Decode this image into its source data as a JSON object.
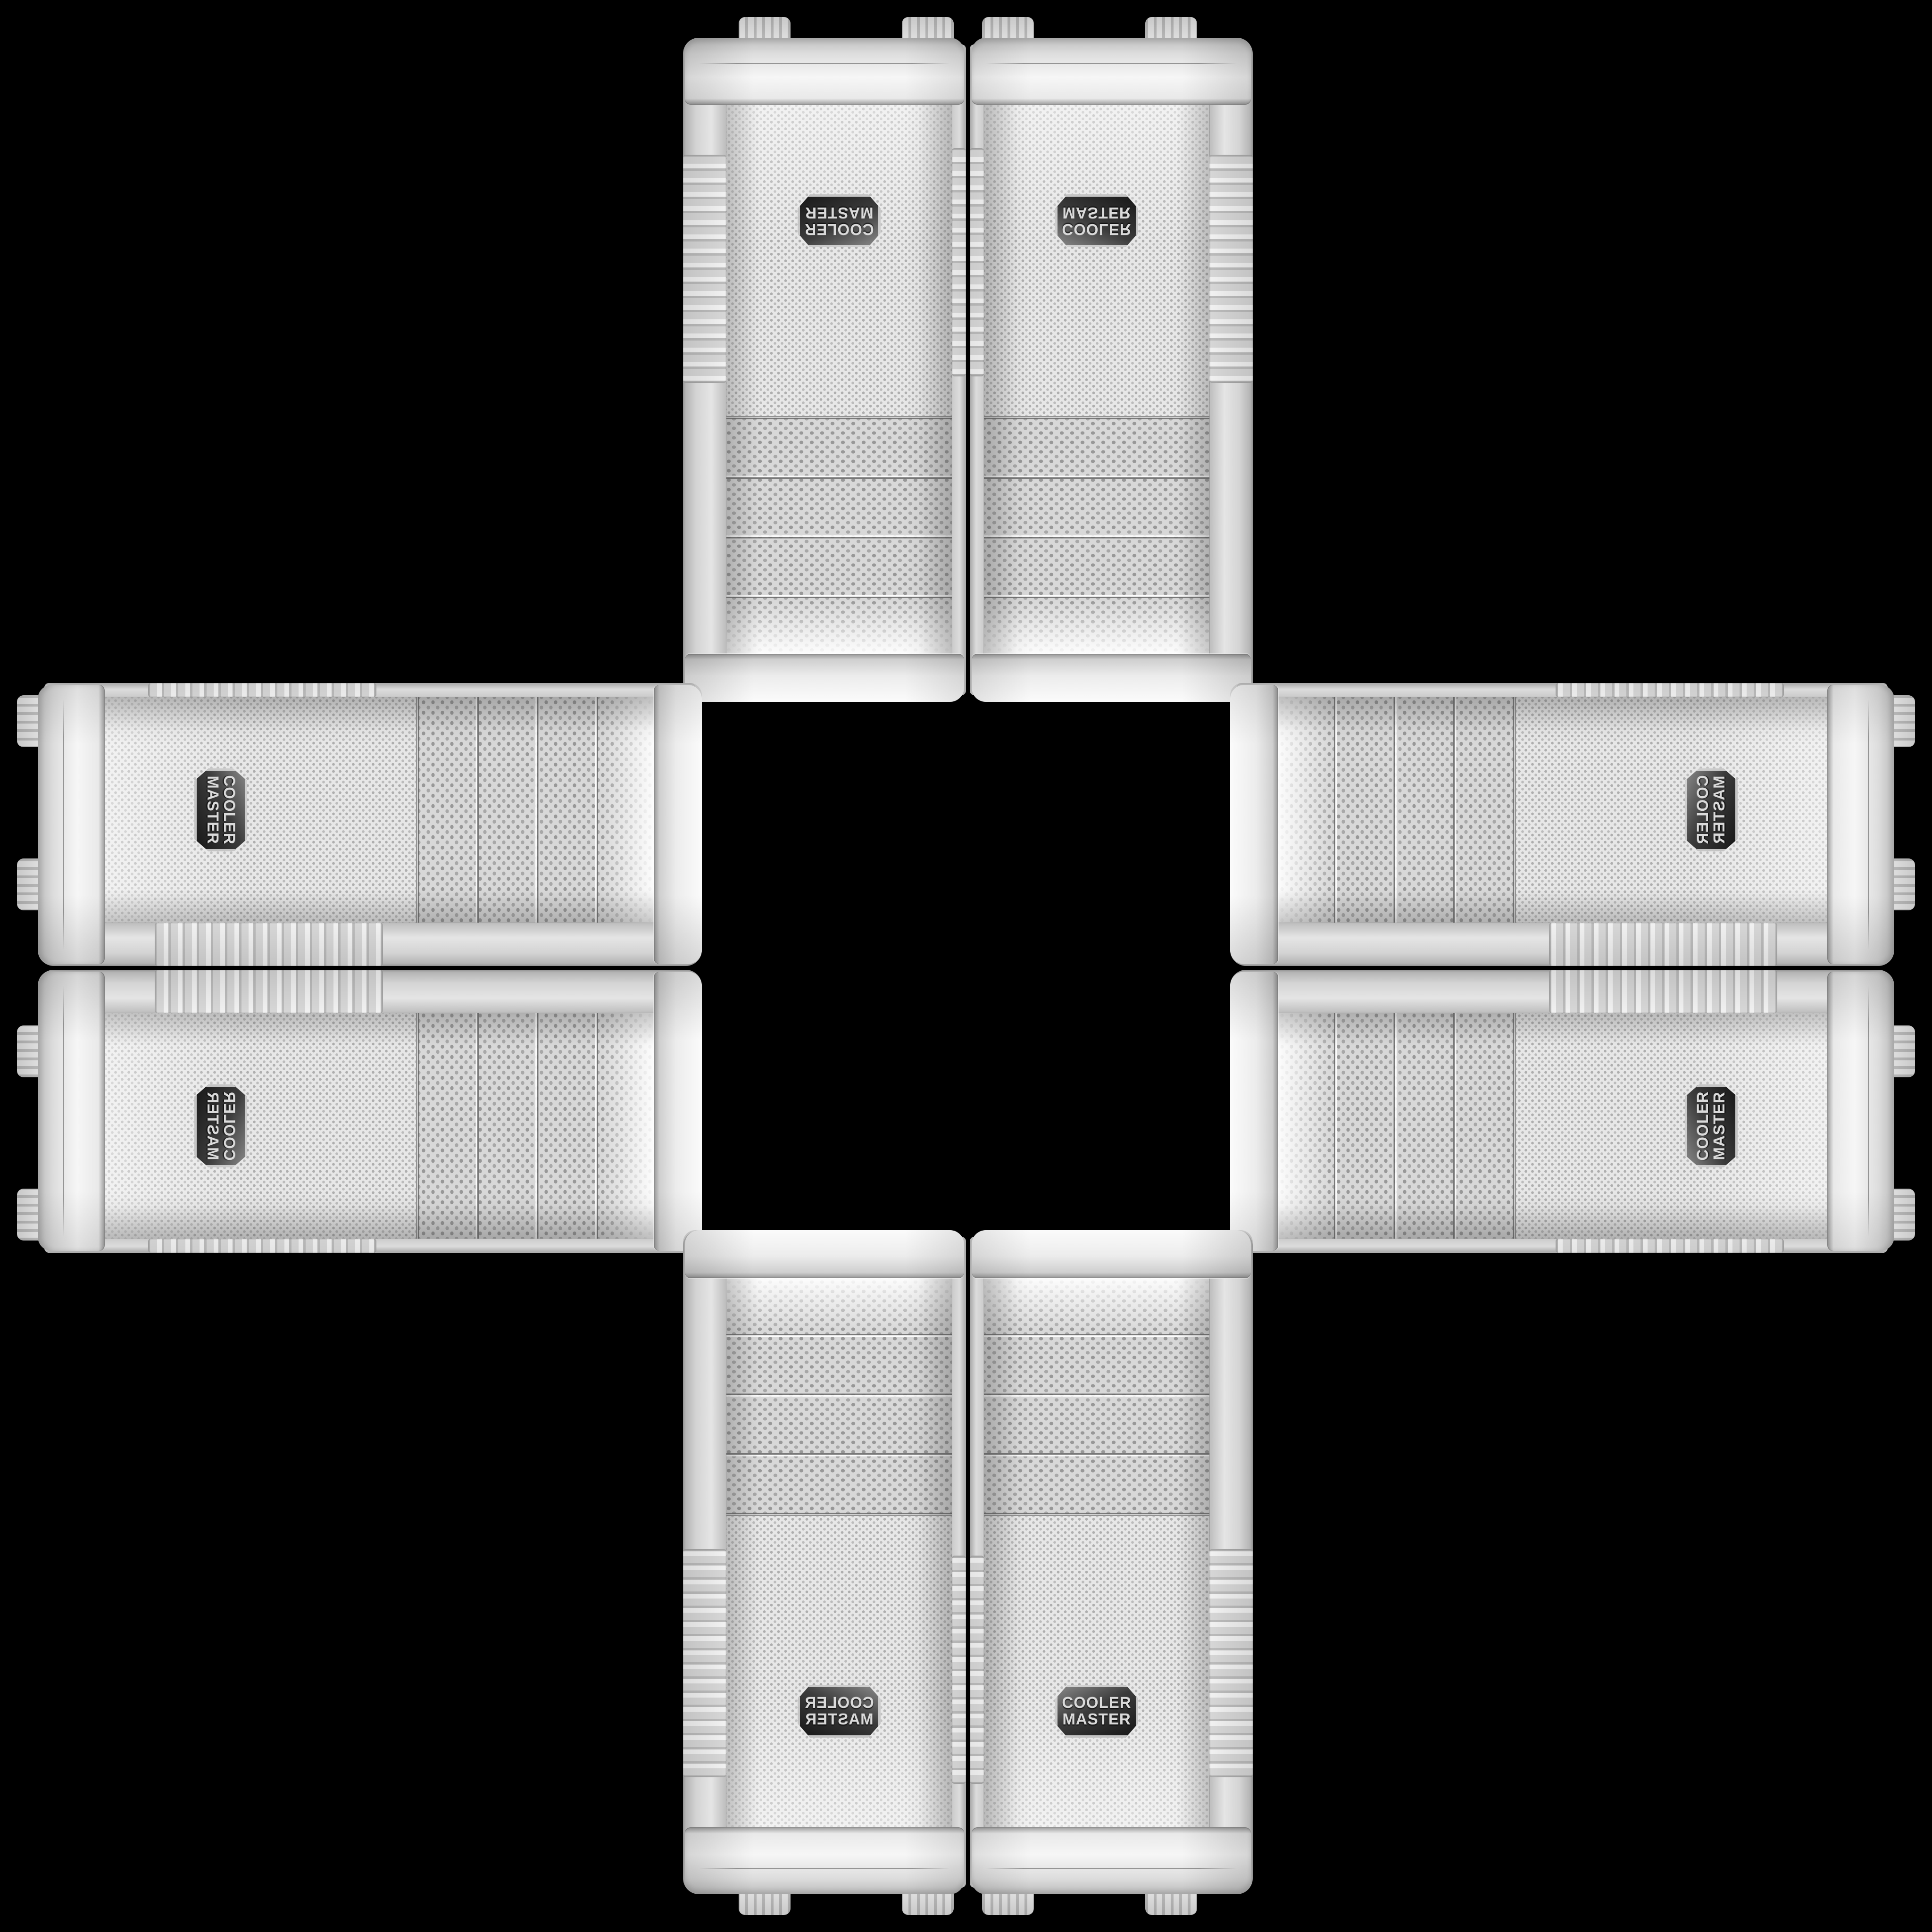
{
  "scene": {
    "background_color": "#000000",
    "description": "Eight copies of the same white Cooler Master PC-case front panel photo arranged in a plus/cross pattern on a black background; each copy is one of the eight mirror/rotation symmetries of the base image, so adjacent panels mirror each other and the centre of the canvas is empty black.",
    "badge": {
      "line1": "COOLER",
      "line2": "MASTER"
    },
    "palette": {
      "background": "#000000",
      "case_white": "#f2f2f2",
      "rail_shadow": "#c7c7c7",
      "mesh_gray": "#e5e5e5",
      "mesh_dot": "#aeaeae",
      "bay_gray": "#d8d8d8",
      "bay_dot": "#989898",
      "chrome_trim": "#8f8f8f",
      "badge_dark": "#2e2e2e",
      "badge_text": "#dadada"
    },
    "panel_features": {
      "drive_bay_covers": 4,
      "grip_ribs": "ribbed band on both side rails",
      "badge_shape": "hexagonal dark emblem",
      "mesh": "perforated dot grille"
    },
    "units": [
      {
        "slot": "top-left",
        "shape": "vert",
        "orientation": "rotated-180",
        "css_transform": "rotate(180deg)"
      },
      {
        "slot": "top-right",
        "shape": "vert",
        "orientation": "flipped-vertical",
        "css_transform": "scaleY(-1)"
      },
      {
        "slot": "left-upper",
        "shape": "horiz",
        "orientation": "rotated-90-cw",
        "css_transform": "rotate(90deg)"
      },
      {
        "slot": "right-upper",
        "shape": "horiz",
        "orientation": "transposed-mirror",
        "css_transform": "rotate(-90deg) scaleX(-1)"
      },
      {
        "slot": "left-lower",
        "shape": "horiz",
        "orientation": "mirrored-rotated-90-ccw",
        "css_transform": "scaleX(-1) rotate(-90deg)"
      },
      {
        "slot": "right-lower",
        "shape": "horiz",
        "orientation": "rotated-90-ccw",
        "css_transform": "rotate(-90deg)"
      },
      {
        "slot": "bottom-left",
        "shape": "vert",
        "orientation": "flipped-horizontal",
        "css_transform": "scaleX(-1)"
      },
      {
        "slot": "bottom-right",
        "shape": "vert",
        "orientation": "upright",
        "css_transform": "none"
      }
    ]
  }
}
